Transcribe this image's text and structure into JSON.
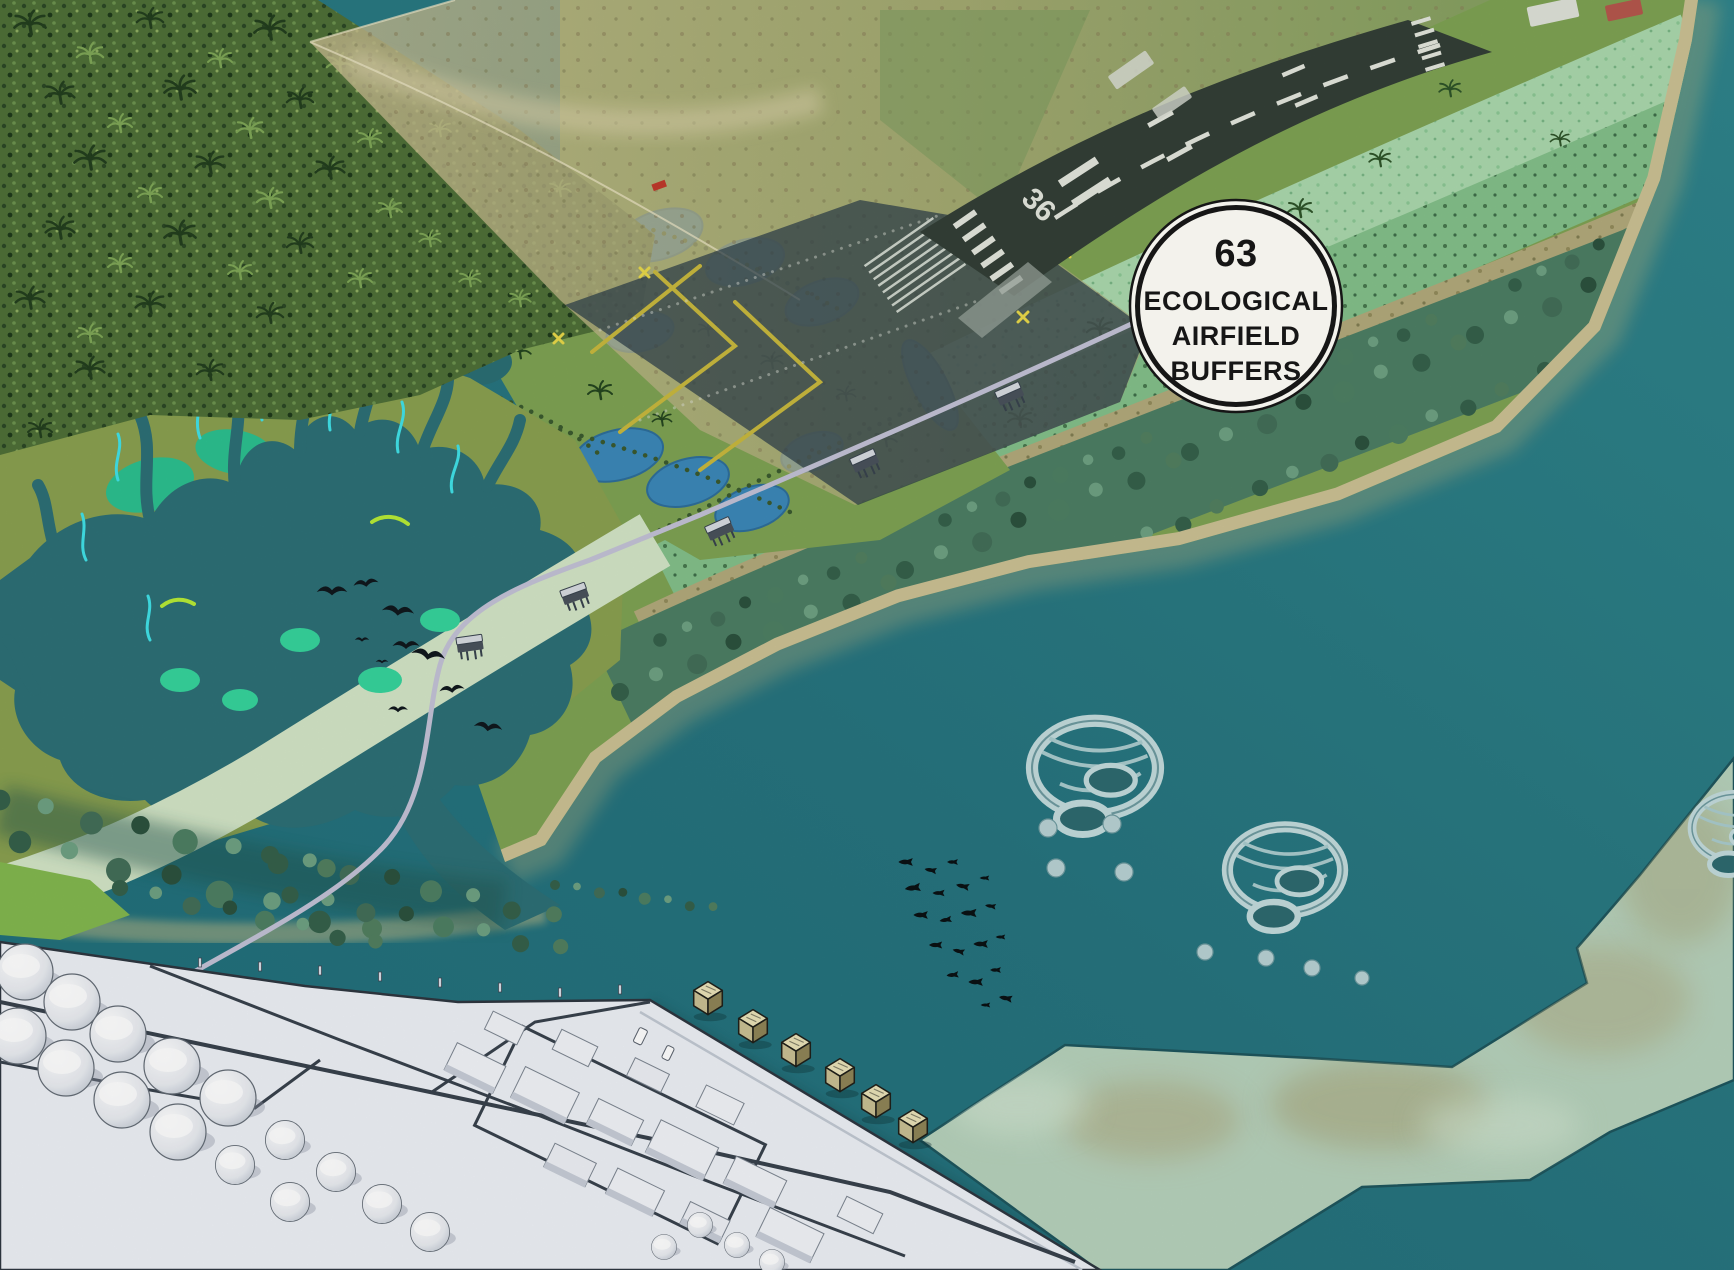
{
  "badge": {
    "number": "63",
    "lines": [
      "ECOLOGICAL",
      "AIRFIELD",
      "BUFFERS"
    ]
  },
  "runway": {
    "designation": "36"
  },
  "palette": {
    "sea": "#2a7b83",
    "sea_deep": "#1f6f7a",
    "shallow_reef": "#b7d2bc",
    "wetland_water": "#2d7076",
    "mangrove_green": "#2cc08f",
    "stream_cyan": "#41e2e8",
    "accent_chartreuse": "#b8eb36",
    "olive_land": "#7ea253",
    "pond_blue": "#3c88b9",
    "runway_dark": "#333f37",
    "marking_white": "#e3e6dd",
    "mint_strip": "#abd8ad",
    "shrub_strip": "#84c08a",
    "sand": "#c6bc8e",
    "dense_trees": "#4d7e64",
    "platform_white": "#eef1f6",
    "badge_bg": "#f3f2ec",
    "badge_ink": "#161616"
  }
}
